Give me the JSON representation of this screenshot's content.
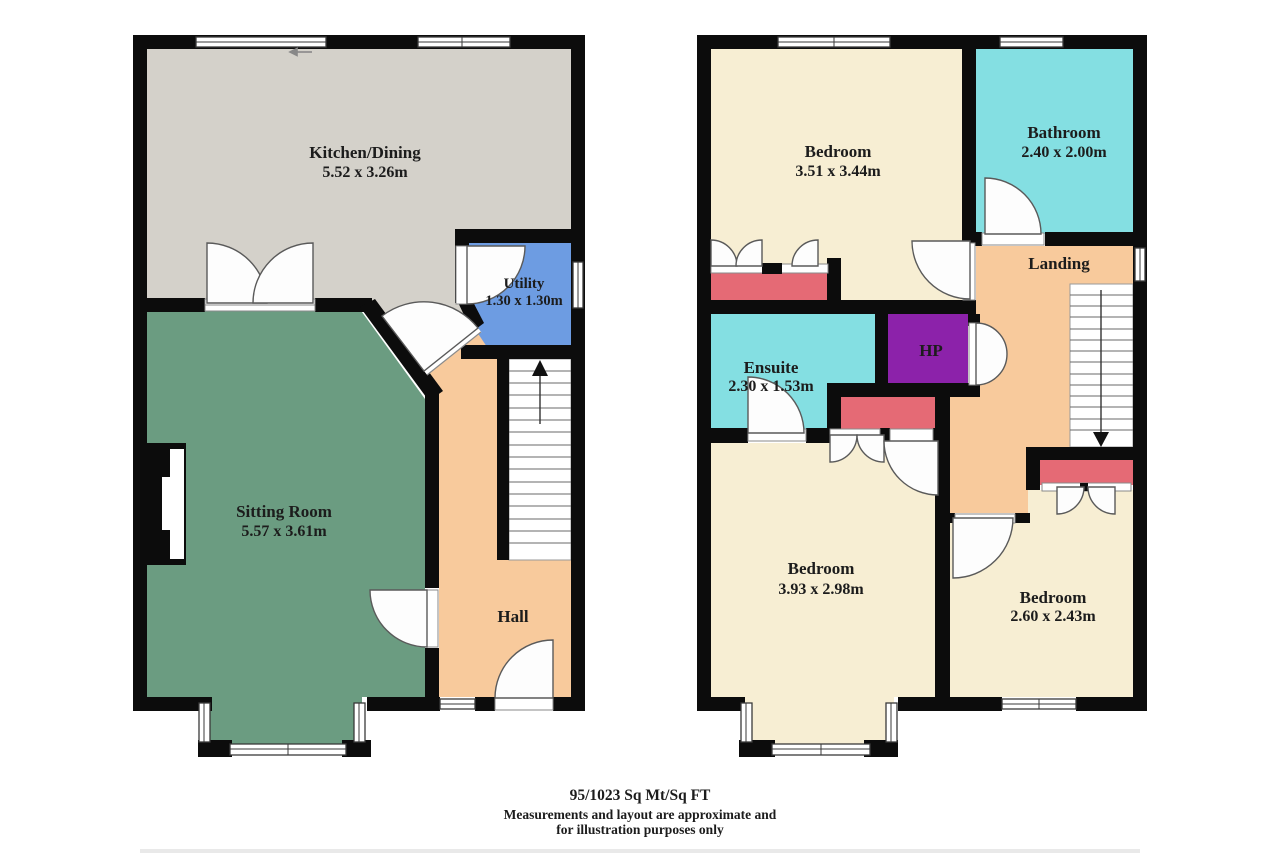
{
  "footer": {
    "area_line": "95/1023 Sq Mt/Sq FT",
    "disclaimer_line1": "Measurements and layout are approximate and",
    "disclaimer_line2": "for illustration purposes only"
  },
  "ground_floor": {
    "stairs_direction": "up",
    "rooms": [
      {
        "name": "Kitchen/Dining",
        "dims": "5.52 x 3.26m"
      },
      {
        "name": "Utility",
        "dims": "1.30 x 1.30m"
      },
      {
        "name": "Sitting Room",
        "dims": "5.57 x 3.61m"
      },
      {
        "name": "Hall",
        "dims": ""
      }
    ]
  },
  "first_floor": {
    "stairs_direction": "down",
    "rooms": [
      {
        "name": "Bedroom",
        "dims": "3.51 x 3.44m"
      },
      {
        "name": "Bathroom",
        "dims": "2.40 x 2.00m"
      },
      {
        "name": "Landing",
        "dims": ""
      },
      {
        "name": "Ensuite",
        "dims": "2.30 x 1.53m"
      },
      {
        "name": "HP",
        "dims": ""
      },
      {
        "name": "Bedroom",
        "dims": "3.93 x 2.98m"
      },
      {
        "name": "Bedroom",
        "dims": "2.60 x 2.43m"
      }
    ]
  },
  "palette": {
    "wall": "#0c0c0c",
    "kitchen": "#d4d1ca",
    "utility": "#6d9ce2",
    "sitting_room": "#6b9c81",
    "hall": "#f8ca9c",
    "landing": "#f8ca9c",
    "bedroom": "#f7eed3",
    "bathroom": "#84dfe2",
    "ensuite": "#84dfe2",
    "hot_press": "#8c22aa",
    "wardrobe": "#e56a75",
    "stairs": "#ffffff"
  }
}
